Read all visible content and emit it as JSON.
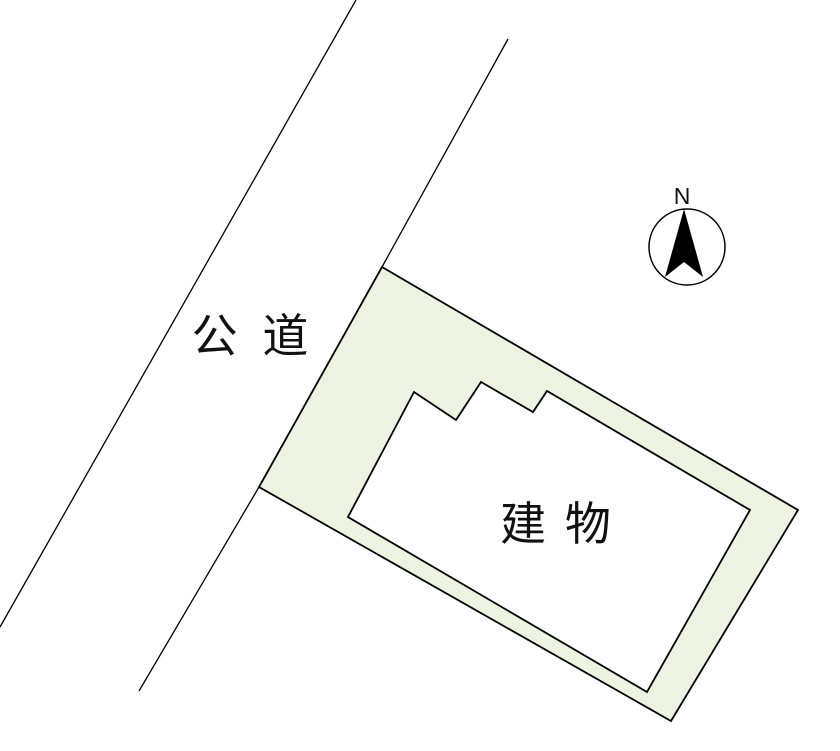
{
  "title": "site-plan-diagram",
  "colors": {
    "background": "#ffffff",
    "parcel_fill": "#eef3e1",
    "building_fill": "#ffffff",
    "outline": "#000000"
  },
  "labels": {
    "road": "公 道",
    "building": "建 物",
    "compass_north": "N"
  },
  "diagram": {
    "road": {
      "name": "public-road",
      "left_line_d": "M 356 0 L 0 627",
      "right_line_d": "M 508 39 L 382 267 L 259 487 L 139 691"
    },
    "parcel": {
      "name": "land-parcel",
      "path_d": "M 382 267 L 798 510 L 671 721 L 259 487 Z"
    },
    "building": {
      "name": "building-footprint",
      "path_d": "M 414 392 L 456 420 L 481 382 L 533 412 L 547 391 L 750 510 L 647 692 L 348 517 Z"
    },
    "compass": {
      "arrow_points": "684,209 703,277 684,262 665,277"
    }
  }
}
